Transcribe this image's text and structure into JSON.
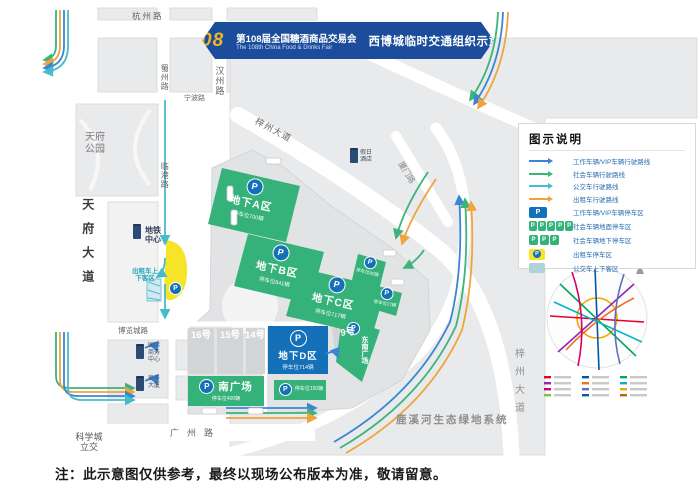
{
  "banner": {
    "number": "108",
    "title_cn": "第108届全国糖酒商品交易会",
    "title_en": "The 108th China Food & Drinks Fair",
    "subtitle": "西博城临时交通组织示意图"
  },
  "roads": {
    "hangzhou_rd": "杭州路",
    "shuzhou_rd": "蜀州路",
    "hanzhou_rd": "汉州路",
    "ningbo_rd": "宁波路",
    "lingang_rd": "临港路",
    "tianfu_ave": "天府大道",
    "tianfu_park": "天府公园",
    "bolancheng_rd": "博览城路",
    "guangzhou_rd": "广州路",
    "kexuecheng": "科学城立交",
    "xiamen_rd": "厦门路",
    "zizhou_ave": "梓州大道",
    "zizhou_ave_s": "梓州大道",
    "luxihe": "鹿溪河生态绿地系统"
  },
  "pois": {
    "metro_center": "地铁中心",
    "taxi_pickup": "出租车上下客区",
    "holiday_hotel": "假日酒店",
    "biz_center": "国际商务中心",
    "biz_tower": "商务大厦"
  },
  "parking": {
    "p": "P",
    "zone_a_name": "地下A区",
    "zone_a_cap": "停车位700辆",
    "zone_b_name": "地下B区",
    "zone_b_cap": "停车位841辆",
    "zone_c_name": "地下C区",
    "zone_c_cap": "停车位717辆",
    "zone_d_name": "地下D区",
    "zone_d_cap": "停车位714辆",
    "south_plaza_name": "南广场",
    "south_plaza_cap": "停车位400辆",
    "east1_cap": "停车位80辆",
    "east2_cap": "停车位27辆",
    "south1_cap": "停车位150辆",
    "southeast_name": "东南广场"
  },
  "halls": {
    "h16": "16号",
    "h15": "15号",
    "h14": "14号",
    "h9": "9号"
  },
  "legend": {
    "title": "图示说明",
    "items": [
      {
        "label": "工作车辆/VIP车辆行驶路线"
      },
      {
        "label": "社会车辆行驶路线"
      },
      {
        "label": "公交车行驶路线"
      },
      {
        "label": "出租车行驶路线"
      },
      {
        "label": "工作车辆/VIP车辆停车区"
      },
      {
        "label": "社会车辆地面停车区"
      },
      {
        "label": "社会车辆地下停车区"
      },
      {
        "label": "出租车停车区"
      },
      {
        "label": "公交车上下客区"
      }
    ]
  },
  "colors": {
    "vip_blue": "#3a86d4",
    "social_green": "#3cb47c",
    "bus_cyan": "#45bccc",
    "taxi_orange": "#f2a33c",
    "parking_blue": "#1470b8",
    "zone_green": "#35b27a",
    "taxi_yellow": "#f6e428",
    "banner_blue": "#1c4d9c"
  },
  "note": "注：此示意图仅供参考，最终以现场公布版本为准，敬请留意。"
}
